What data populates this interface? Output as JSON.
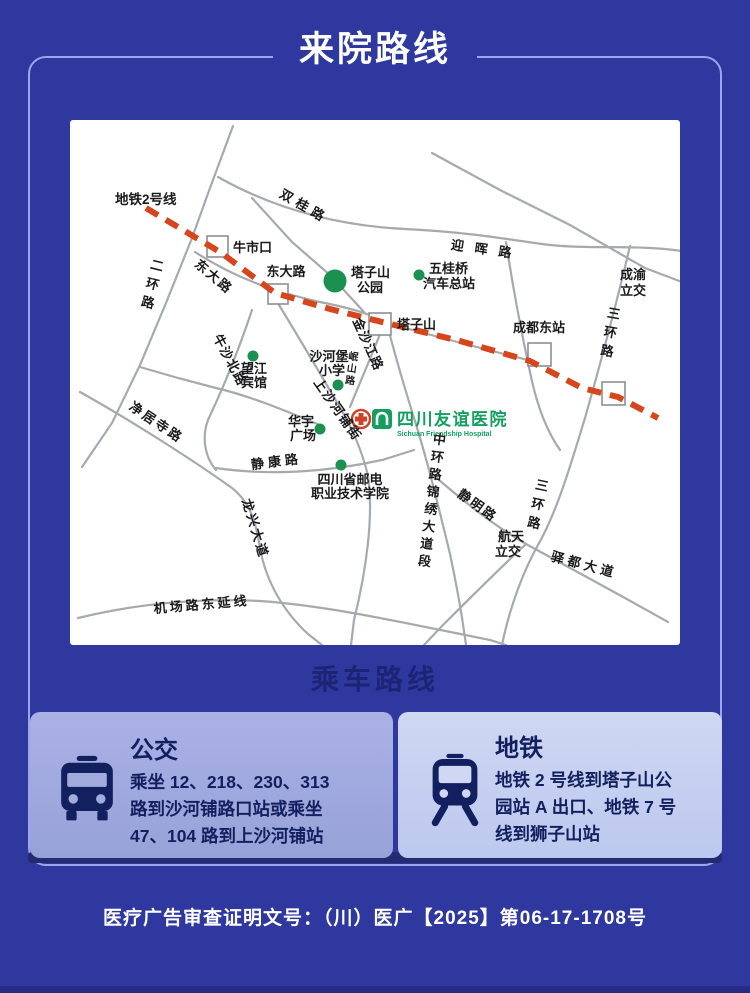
{
  "theme": {
    "page_bg": "#2e389f",
    "frame_border": "#98a8ea",
    "section_title_color": "#1c2574",
    "card_bus_bg": "#a3ace0",
    "card_metro_bg": "#c7d1f0",
    "card_ink": "#13205f",
    "metro_dash_red": "#d6451b",
    "road_gray": "#a6a9ad",
    "poi_green": "#1b9150",
    "hospital_green": "#149e5f"
  },
  "header": {
    "title": "来院路线"
  },
  "map": {
    "metro_line_label": "地铁2号线",
    "roads": {
      "shuanggui": "双桂路",
      "yinghui": "迎晖路",
      "erhuan": "二环路",
      "dongda_diag": "东大路",
      "dongda_station": "东大路",
      "jinshajiang": "金沙江路",
      "minshan": "岷山路",
      "shangshahepu": "上沙河铺街",
      "niushabei": "牛沙北路",
      "jingjusi": "净居寺路",
      "jingkang": "静康路",
      "longxing": "龙兴大道",
      "jichang": "机场路东延线",
      "zhonghuan": "中环路锦绣大道段",
      "jingming": "静明路",
      "sanhuan_a": "三环路",
      "sanhuan_b": "三环路",
      "chengyu_line1": "成渝",
      "chengyu_line2": "立交",
      "hangtian_line1": "航天",
      "hangtian_line2": "立交",
      "yidu": "驿都大道"
    },
    "stations": {
      "niushikou": "牛市口",
      "tazishan": "塔子山",
      "chengdudong": "成都东站"
    },
    "pois": {
      "park_line1": "塔子山",
      "park_line2": "公园",
      "wugui_line1": "五桂桥",
      "wugui_line2": "汽车总站",
      "shahebao_line1": "沙河堡",
      "shahebao_line2": "小学",
      "wangjiang_line1": "望江",
      "wangjiang_line2": "宾馆",
      "huayu_line1": "华宇",
      "huayu_line2": "广场",
      "youdian_line1": "四川省邮电",
      "youdian_line2": "职业技术学院"
    },
    "hospital": {
      "cn": "四川友谊医院",
      "en": "Sichuan Friendship Hospital"
    }
  },
  "section_title": "乘车路线",
  "cards": {
    "bus": {
      "title": "公交",
      "lines": [
        "乘坐 12、218、230、313",
        "路到沙河铺路口站或乘坐",
        "47、104 路到上沙河铺站"
      ]
    },
    "metro": {
      "title": "地铁",
      "lines": [
        "地铁 2 号线到塔子山公",
        "园站 A 出口、地铁 7 号",
        "线到狮子山站"
      ]
    }
  },
  "footer": {
    "license": "医疗广告审查证明文号：（川）医广【2025】第06-17-1708号"
  }
}
